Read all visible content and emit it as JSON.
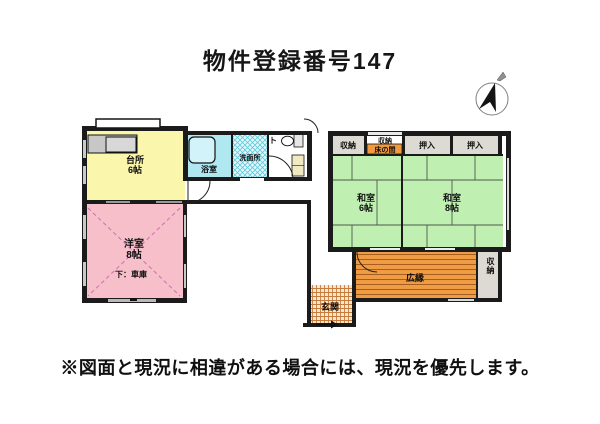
{
  "title": "物件登録番号147",
  "disclaimer": "※図面と現況に相違がある場合には、現況を優先します。",
  "compass": {
    "name": "north-arrow"
  },
  "rooms": {
    "kitchen": {
      "name": "台所",
      "size": "6帖"
    },
    "bath": {
      "name": "浴室"
    },
    "washroom": {
      "name": "洗面所"
    },
    "toilet": {
      "name": "ト"
    },
    "storage_a": {
      "name": "収納"
    },
    "storage_b": {
      "name": "収納"
    },
    "tokonoma": {
      "name": "床の間"
    },
    "oshiire_a": {
      "name": "押入"
    },
    "oshiire_b": {
      "name": "押入"
    },
    "washitsu6": {
      "name": "和室",
      "size": "6帖"
    },
    "washitsu8": {
      "name": "和室",
      "size": "8帖"
    },
    "youshitsu": {
      "name": "洋室",
      "size": "8帖",
      "note": "下：車庫"
    },
    "veranda": {
      "name": "広縁"
    },
    "storage_right": {
      "name": "収納"
    },
    "entrance": {
      "name": "玄関"
    }
  },
  "colors": {
    "kitchen": "#faf6ac",
    "western_room": "#f6bfc9",
    "tatami": "#c0efb2",
    "bath": "#b0e8f2",
    "tub": "#d2f3f9",
    "veranda": "#f09c44",
    "tokonoma": "#f29a3e",
    "closet": "#dcdad2",
    "wall": "#1b1b1b"
  }
}
